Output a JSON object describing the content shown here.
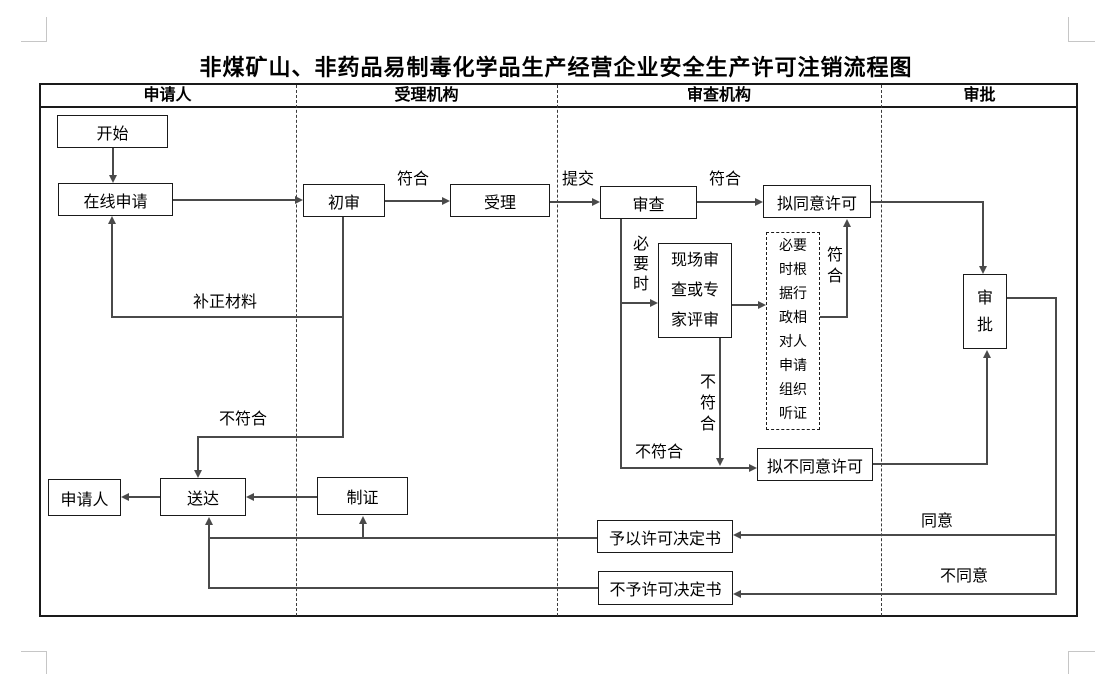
{
  "title": "非煤矿山、非药品易制毒化学品生产经营企业安全生产许可注销流程图",
  "lanes": {
    "applicant": "申请人",
    "accepting": "受理机构",
    "reviewing": "审查机构",
    "approval": "审批"
  },
  "nodes": {
    "start": "开始",
    "online_apply": "在线申请",
    "preliminary_review": "初审",
    "accept": "受理",
    "review": "审查",
    "propose_approve": "拟同意许可",
    "onsite_review": "现场审查或专家评审",
    "hearing_note": "必要时根据行政相对人申请组织听证",
    "approval": "审批",
    "propose_disapprove": "拟不同意许可",
    "applicant_receive": "申请人",
    "deliver": "送达",
    "make_cert": "制证",
    "grant_decision": "予以许可决定书",
    "deny_decision": "不予许可决定书"
  },
  "labels": {
    "conform": "符合",
    "submit": "提交",
    "when_necessary": "必要时",
    "not_conform": "不符合",
    "supplement": "补正材料",
    "agree": "同意",
    "disagree": "不同意"
  },
  "colors": {
    "ink": "#1a1a1a",
    "connector": "#4a4a4a",
    "background": "#ffffff",
    "crop_mark": "#c6c6c6"
  }
}
